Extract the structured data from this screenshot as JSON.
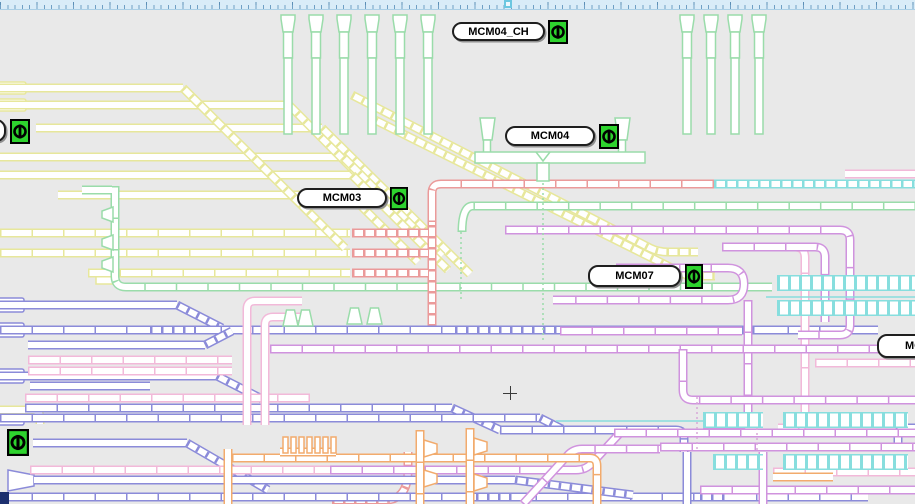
{
  "canvas": {
    "width": 915,
    "height": 504,
    "background": "#e9e9e9"
  },
  "ruler": {
    "band_color": "#d9ecf8",
    "tick_color": "#6f9fc4",
    "marker_color": "#6cc7e0"
  },
  "stations": {
    "mcm04_ch": {
      "label": "MCM04_CH"
    },
    "mcm04": {
      "label": "MCM04"
    },
    "mcm03": {
      "label": "MCM03"
    },
    "mcm07": {
      "label": "MCM07"
    },
    "right_partial": {
      "label": "MC"
    }
  },
  "indicator": {
    "color": "#2ed32e",
    "count": 6
  },
  "track_colors": {
    "yellow": "#e7e79b",
    "green": "#9adcaa",
    "red": "#eb9a9a",
    "purple": "#d093de",
    "pink": "#f2b9d9",
    "blue": "#8b8bd9",
    "orange": "#f2ab6d",
    "cyan": "#87dede",
    "navy": "#1c2f6e"
  }
}
